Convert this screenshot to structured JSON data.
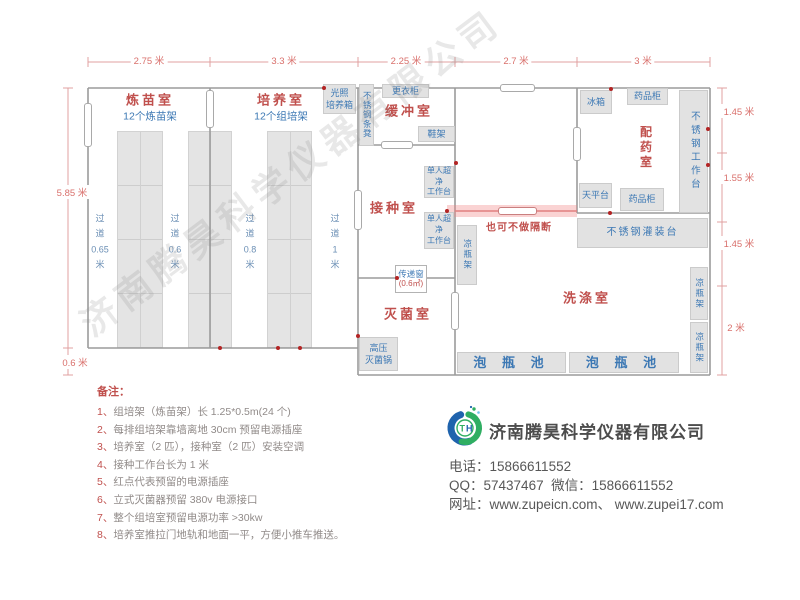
{
  "dimensions": {
    "top": [
      {
        "label": "2.75 米"
      },
      {
        "label": "3.3 米"
      },
      {
        "label": "2.25 米"
      },
      {
        "label": "2.7 米"
      },
      {
        "label": "3 米"
      }
    ],
    "left": [
      {
        "label": "5.85 米"
      },
      {
        "label": "0.6 米"
      }
    ],
    "right": [
      {
        "label": "1.45 米"
      },
      {
        "label": "1.55 米"
      },
      {
        "label": "1.45 米"
      },
      {
        "label": "2 米"
      }
    ]
  },
  "rooms": {
    "lianmiao": {
      "label": "炼苗室",
      "sub": "12个炼苗架"
    },
    "peiyang": {
      "label": "培养室",
      "sub": "12个组培架"
    },
    "huanchong": {
      "label": "缓冲室"
    },
    "jiezhong": {
      "label": "接种室"
    },
    "miejun": {
      "label": "灭菌室"
    },
    "xidi": {
      "label": "洗涤室"
    },
    "peiyao": {
      "label": "配药室"
    }
  },
  "aisles": [
    {
      "label": "过\n道\n0.65\n米"
    },
    {
      "label": "过\n道\n0.6\n米"
    },
    {
      "label": "过\n道\n0.8\n米"
    },
    {
      "label": "过\n道\n1\n米"
    }
  ],
  "equipment": {
    "light_incubator": "光照\n培养箱",
    "ss_bench": "不锈钢条凳",
    "wardrobe": "更衣柜",
    "shoe_rack": "鞋架",
    "clean_bench_1": "单人超净\n工作台",
    "clean_bench_2": "单人超净\n工作台",
    "bottle_rack_mid": "凉瓶架",
    "autoclave": "高压\n灭菌锅",
    "fridge": "冰箱",
    "medicine_cabinet_top": "药品柜",
    "ss_worktable": "不锈钢工作台",
    "balance_table": "天平台",
    "medicine_cabinet_bottom": "药品柜",
    "ss_filling_table": "不锈钢灌装台",
    "bottle_rack_r1": "凉瓶架",
    "bottle_rack_r2": "凉瓶架",
    "soak_pool_1": "泡 瓶 池",
    "soak_pool_2": "泡 瓶 池"
  },
  "transfer_window": {
    "label": "传递窗",
    "area": "(0.6㎡)"
  },
  "partition": {
    "note": "也可不做隔断"
  },
  "notes": {
    "heading": "备注：",
    "items": [
      {
        "num": "1、",
        "text": "组培架（炼苗架）长 1.25*0.5m(24 个)"
      },
      {
        "num": "2、",
        "text": "每排组培架靠墙离地 30cm 预留电源插座"
      },
      {
        "num": "3、",
        "text": "培养室（2 匹），接种室（2 匹）安装空调"
      },
      {
        "num": "4、",
        "text": "接种工作台长为 1 米"
      },
      {
        "num": "5、",
        "text": "红点代表预留的电源插座"
      },
      {
        "num": "6、",
        "text": "立式灭菌器预留 380v 电源接口"
      },
      {
        "num": "7、",
        "text": "整个组培室预留电源功率 >30kw"
      },
      {
        "num": "8、",
        "text": "培养室推拉门地轨和地面一平，方便小推车推送。"
      }
    ]
  },
  "company": {
    "name": "济南腾昊科学仪器有限公司",
    "logo_t": "T",
    "logo_h": "H",
    "phone_label": "电话：",
    "phone": "15866611552",
    "qq_label": "QQ：",
    "qq": "57437467",
    "wechat_label": "  微信：",
    "wechat": "15866611552",
    "web_label": "网址：",
    "web": "www.zupeicn.com、 www.zupei17.com"
  },
  "watermark": "济南腾昊科学仪器有限公司",
  "colors": {
    "wall": "#9b9b9b",
    "dimension": "#e0a0a0",
    "room_label": "#c0504d",
    "equipment_label": "#3c78b4",
    "socket_dot": "#b32424",
    "partition_highlight": "#f08282"
  }
}
